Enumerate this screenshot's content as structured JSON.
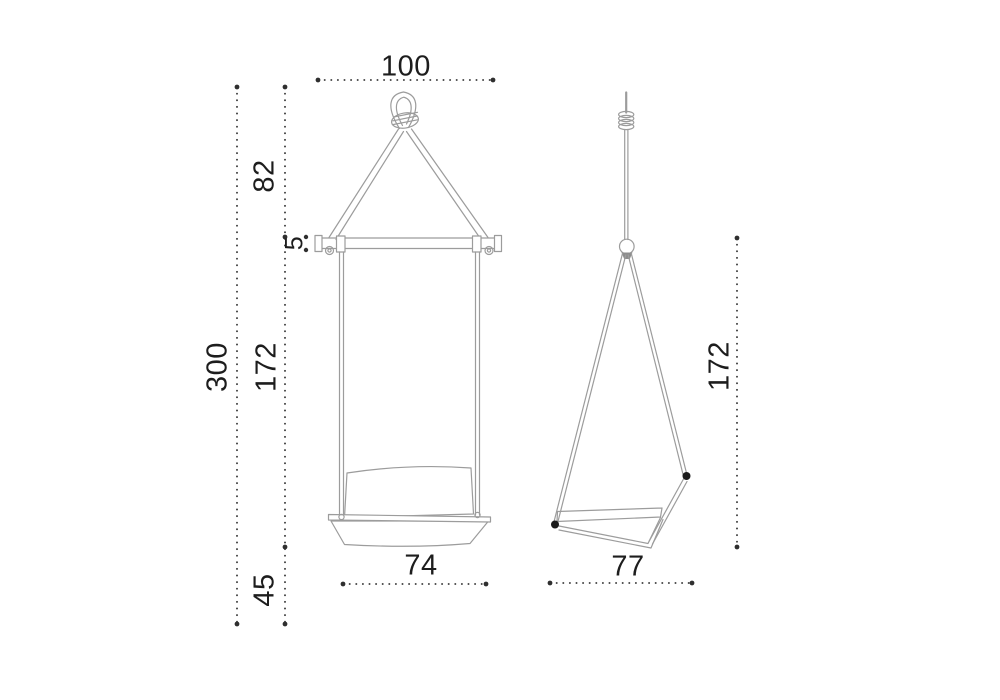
{
  "figure": {
    "type": "technical-dimension-drawing",
    "subject": "hanging swing chair, front and side elevation views"
  },
  "dimensions": {
    "front": {
      "hang_width": "100",
      "rope_height": "82",
      "bar_thickness": "5",
      "total_height": "300",
      "strap_drop": "172",
      "seat_height": "45",
      "seat_width": "74"
    },
    "side": {
      "drop_height": "172",
      "seat_depth": "77"
    }
  },
  "colors": {
    "background": "#ffffff",
    "drawing_line": "#9c9c9c",
    "dimension_line": "#2f2f2f",
    "dimension_text": "#1d1d1d",
    "anchor_dot": "#1b1b1b"
  }
}
